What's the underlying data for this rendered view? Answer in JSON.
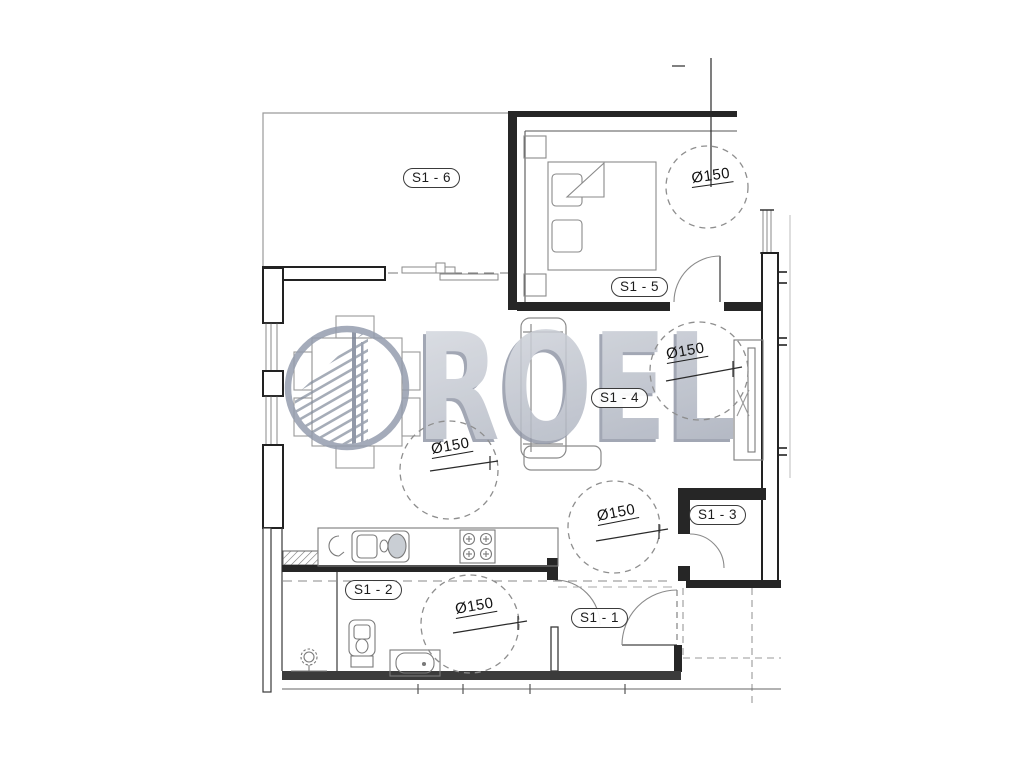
{
  "watermark": {
    "brand": "ROEL"
  },
  "rooms": [
    {
      "label": "S1 - 6"
    },
    {
      "label": "S1 - 5"
    },
    {
      "label": "S1 - 4"
    },
    {
      "label": "S1 - 3"
    },
    {
      "label": "S1 - 2"
    },
    {
      "label": "S1 - 1"
    }
  ],
  "annotations": {
    "turning_circles": [
      {
        "label": "Ø150"
      },
      {
        "label": "Ø150"
      },
      {
        "label": "Ø150"
      },
      {
        "label": "Ø150"
      },
      {
        "label": "Ø150"
      }
    ]
  }
}
